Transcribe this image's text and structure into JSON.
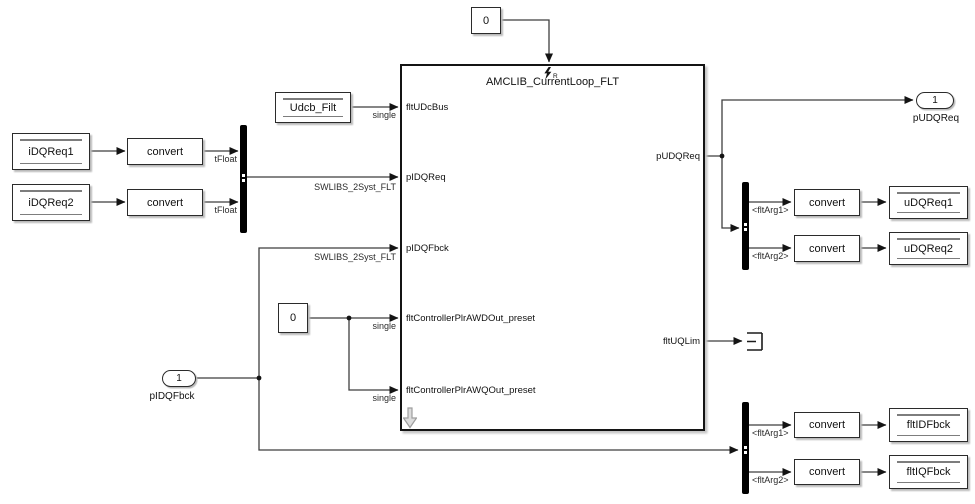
{
  "main_block": {
    "title": "AMCLIB_CurrentLoop_FLT",
    "reset_port_label": "R",
    "input_ports": [
      "fltUDcBus",
      "pIDQReq",
      "pIDQFbck",
      "fltControllerPlrAWDOut_preset",
      "fltControllerPlrAWQOut_preset"
    ],
    "output_ports": [
      "pUDQReq",
      "fltUQLim"
    ]
  },
  "tag_blocks": {
    "iDQReq1": "iDQReq1",
    "iDQReq2": "iDQReq2",
    "udcb_filt": "Udcb_Filt",
    "uDQReq1": "uDQReq1",
    "uDQReq2": "uDQReq2",
    "fltIDFbck": "fltIDFbck",
    "fltIQFbck": "fltIQFbck"
  },
  "convert_block_label": "convert",
  "constant_blocks": {
    "reset_constant": "0",
    "preset_constant": "0"
  },
  "inport": {
    "number": "1",
    "label": "pIDQFbck"
  },
  "outport": {
    "number": "1",
    "label": "pUDQReq"
  },
  "wire_labels": {
    "tFloat": "tFloat",
    "single": "single",
    "bus_type": "SWLIBS_2Syst_FLT",
    "fltArg1": "<fltArg1>",
    "fltArg2": "<fltArg2>"
  }
}
